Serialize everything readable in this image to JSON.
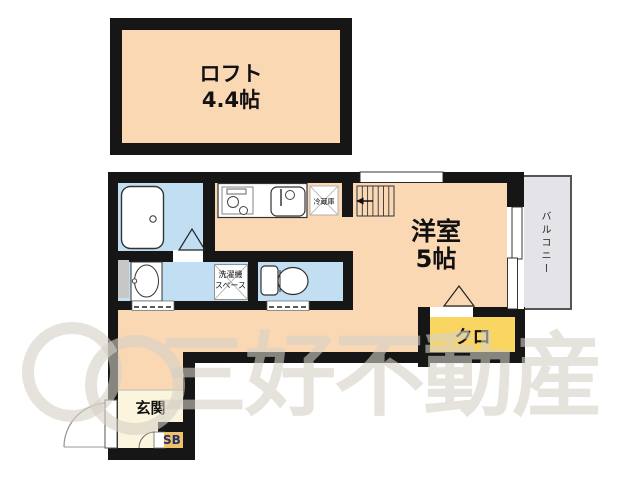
{
  "type": "floor-plan",
  "rooms": {
    "loft": {
      "name": "ロフト",
      "size": "4.4帖"
    },
    "western": {
      "name": "洋室",
      "size": "5帖"
    },
    "closet": {
      "label": "クロ"
    },
    "entrance": {
      "label": "玄関"
    },
    "shoe_box": {
      "label": "SB"
    },
    "balcony": {
      "label": "バルコニー"
    }
  },
  "fixtures": {
    "fridge": {
      "label": "冷蔵庫"
    },
    "washer_space": {
      "line1": "洗濯機",
      "line2": "スペース"
    }
  },
  "watermark": {
    "text": "三好不動産"
  },
  "colors": {
    "room_floor": "#FAD8B4",
    "wet_area": "#C2DEF3",
    "closet": "#F9D661",
    "entrance": "#FAF5DC",
    "shoe_box": "#EFC36B",
    "balcony": "#E4E4E8",
    "wall": "#161616"
  }
}
